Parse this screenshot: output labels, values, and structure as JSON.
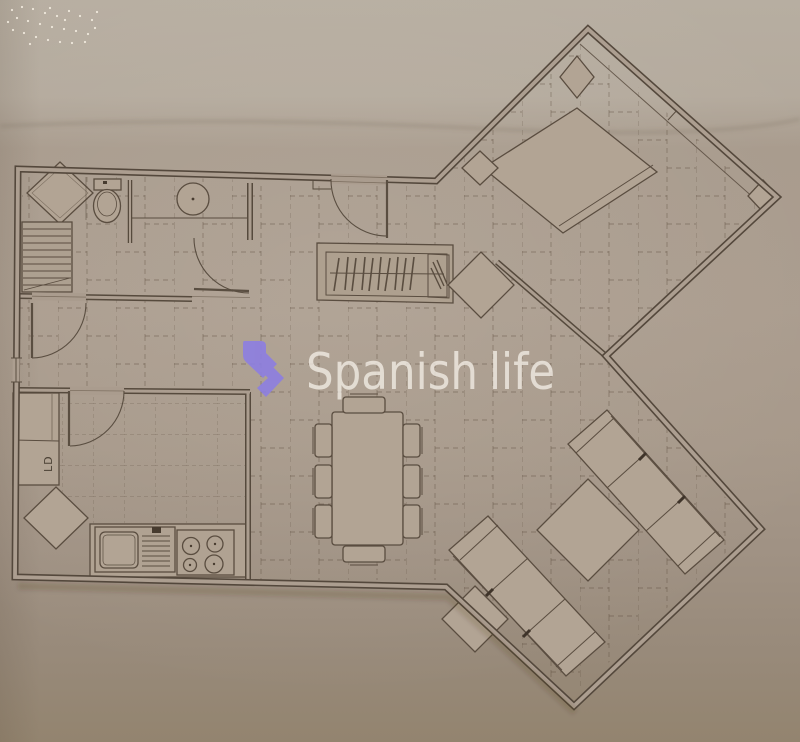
{
  "watermark": {
    "brand_first": "Spanish",
    "brand_second": "life",
    "logo_color": "#8d7ee1",
    "text_color": "#f3eee6"
  },
  "plan": {
    "labels": {
      "ld": "LD"
    }
  },
  "colors": {
    "background_top": "#b6ad9f",
    "background_mid": "#a89a8c",
    "background_bottom": "#93846f",
    "line": "#54483c",
    "furniture_fill": "#b2a494",
    "accent_purple": "#8d7ee1"
  }
}
